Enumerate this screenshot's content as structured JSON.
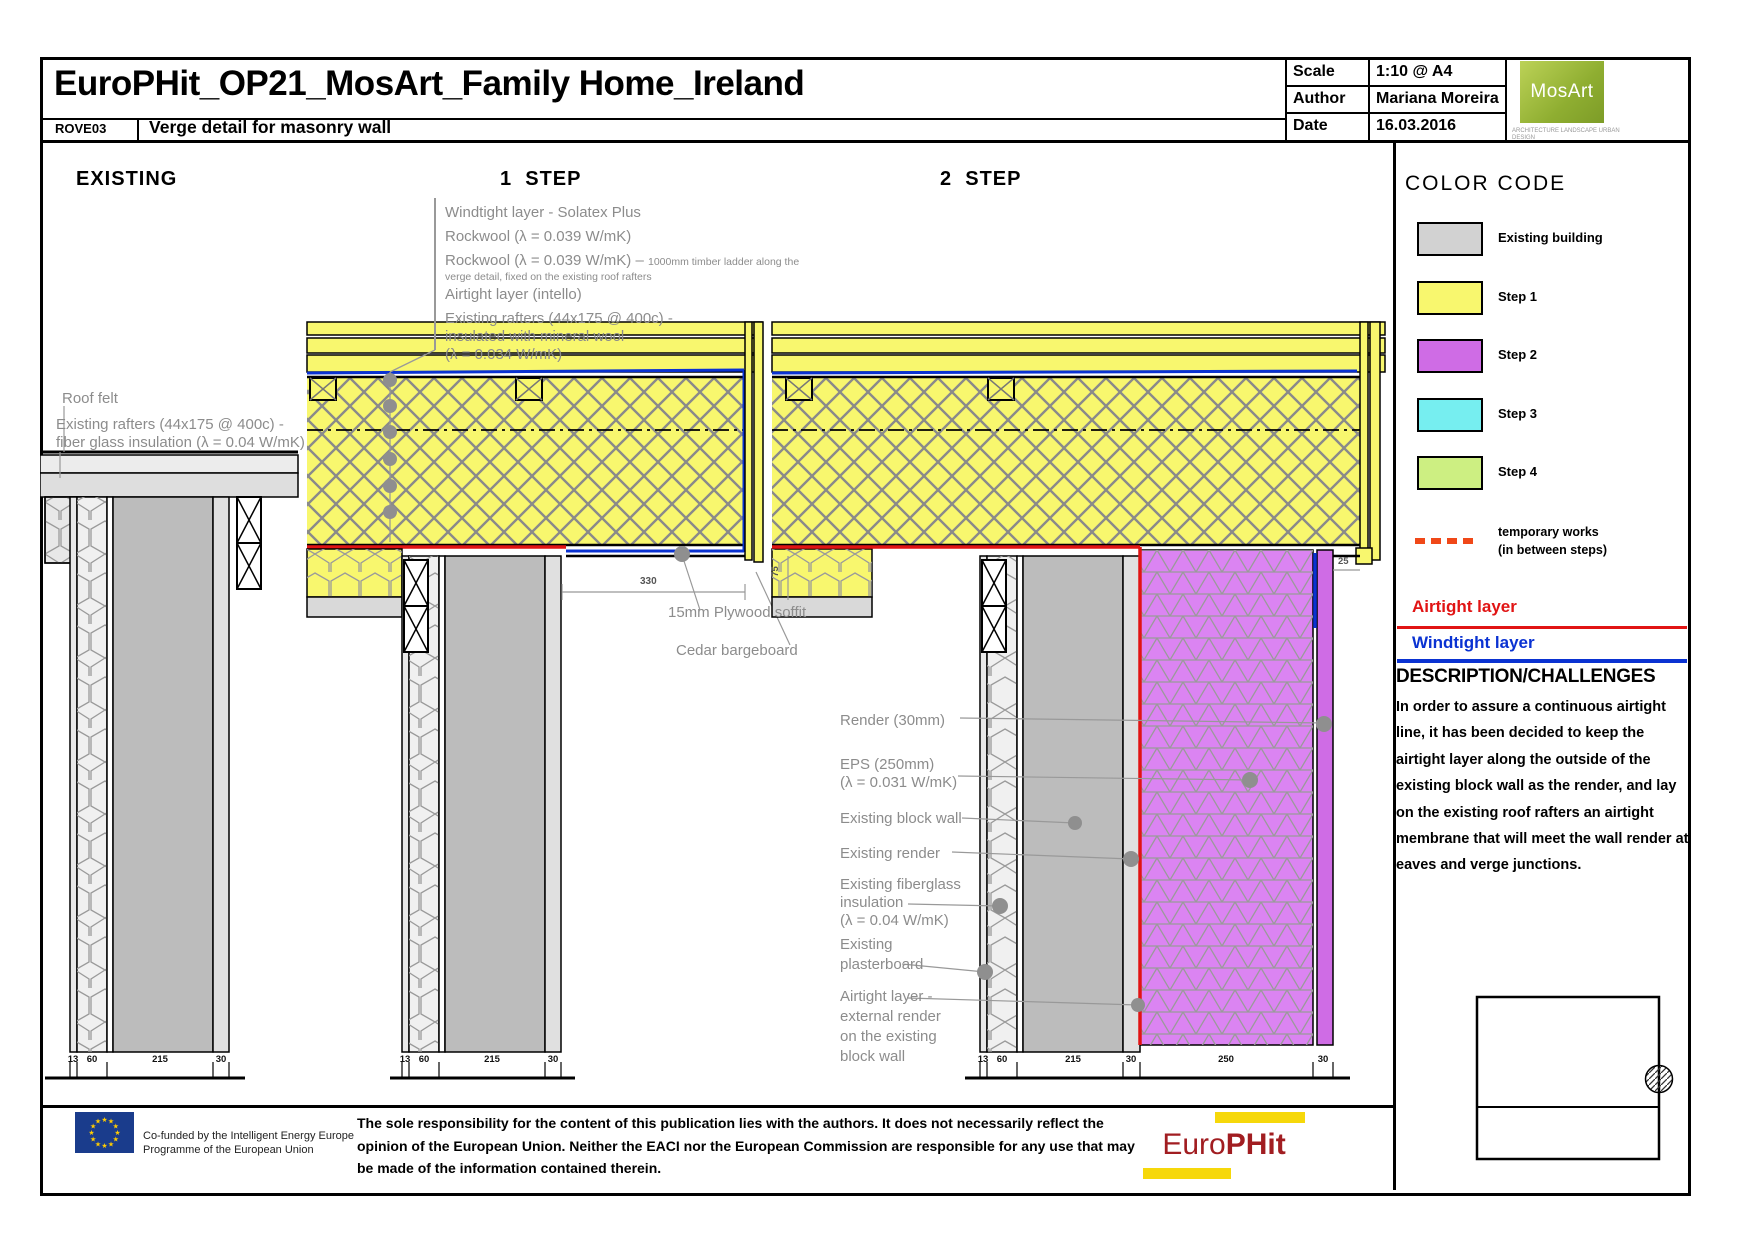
{
  "header": {
    "title": "EuroPHit_OP21_MosArt_Family Home_Ireland",
    "drawing_code": "ROVE03",
    "drawing_title": "Verge detail for masonry wall",
    "meta": {
      "scale_label": "Scale",
      "scale_value": "1:10 @ A4",
      "author_label": "Author",
      "author_value": "Mariana Moreira",
      "date_label": "Date",
      "date_value": "16.03.2016"
    },
    "logo": {
      "name": "MosArt",
      "tagline": "ARCHITECTURE LANDSCAPE URBAN DESIGN"
    }
  },
  "sections": {
    "existing": "EXISTING",
    "step1": "1  STEP",
    "step2": "2  STEP"
  },
  "labels": {
    "existing": {
      "roof_felt": "Roof felt",
      "rafters_1": "Existing rafters (44x175 @ 400c) -",
      "rafters_2": "fiber glass insulation (λ = 0.04 W/mK)"
    },
    "step1": {
      "windtight": "Windtight layer - Solatex Plus",
      "rockwool_1": "Rockwool (λ = 0.039 W/mK)",
      "rockwool_2": "Rockwool (λ = 0.039 W/mK) – ",
      "rockwool_2_note_a": "1000mm timber ladder along the",
      "rockwool_2_note_b": "verge detail, fixed on the existing roof rafters",
      "airtight": "Airtight layer (intello)",
      "rafters_1": "Existing rafters (44x175 @ 400c) -",
      "rafters_2": "insulated with mineral wool",
      "rafters_3": "(λ = 0.034 W/mK)",
      "soffit": "15mm Plywood soffit",
      "bargeboard": "Cedar bargeboard"
    },
    "step2": {
      "render": "Render (30mm)",
      "eps_1": "EPS (250mm)",
      "eps_2": "(λ = 0.031 W/mK)",
      "block_wall": "Existing block wall",
      "existing_render": "Existing render",
      "fiberglass_1": "Existing fiberglass",
      "fiberglass_2": "insulation",
      "fiberglass_3": "(λ = 0.04 W/mK)",
      "plasterboard_1": "Existing",
      "plasterboard_2": "plasterboard",
      "airtight_1": "Airtight layer -",
      "airtight_2": "external render",
      "airtight_3": "on the existing",
      "airtight_4": "block wall"
    }
  },
  "dimensions": {
    "soffit_width": "330",
    "step2_vert": "75",
    "step2_barge": "25",
    "existing_run": [
      "13",
      "60",
      "215",
      "30"
    ],
    "step1_run": [
      "13",
      "60",
      "215",
      "30"
    ],
    "step2_run": [
      "13",
      "60",
      "215",
      "30",
      "250",
      "30"
    ]
  },
  "sidebar": {
    "color_code_title": "COLOR CODE",
    "legend": [
      {
        "label": "Existing building",
        "color": "#d2d2d2"
      },
      {
        "label": "Step 1",
        "color": "#f8f76e"
      },
      {
        "label": "Step 2",
        "color": "#cf6ce5"
      },
      {
        "label": "Step 3",
        "color": "#76eef0"
      },
      {
        "label": "Step 4",
        "color": "#cdef82"
      }
    ],
    "temporary_works_1": "temporary works",
    "temporary_works_2": "(in between steps)",
    "airtight_label": "Airtight layer",
    "windtight_label": "Windtight layer",
    "description_title": "DESCRIPTION/CHALLENGES",
    "description_body": "In order to assure a continuous airtight line, it has been decided to keep the airtight layer along the outside of the existing block wall as the render, and lay on the existing roof rafters an airtight membrane that will meet the wall render at eaves and verge junctions."
  },
  "footer": {
    "flag_icon": "eu-stars-flag",
    "eu_text_1": "Co-funded by the Intelligent Energy Europe",
    "eu_text_2": "Programme of the European Union",
    "disclaimer": "The sole responsibility for the content of this publication lies with the authors. It does not necessarily reflect the opinion of the European Union. Neither the EACI nor the European Commission are responsible for any use that may be made of the information contained therein.",
    "europhit_1": "Euro",
    "europhit_2": "PHit"
  },
  "colors": {
    "existing": "#d2d2d2",
    "step1": "#f8f76e",
    "step2": "#cf6ce5",
    "step3": "#76eef0",
    "step4": "#cdef82",
    "airtight": "#e11414",
    "windtight": "#0a32d2",
    "temporary": "#f04818"
  }
}
